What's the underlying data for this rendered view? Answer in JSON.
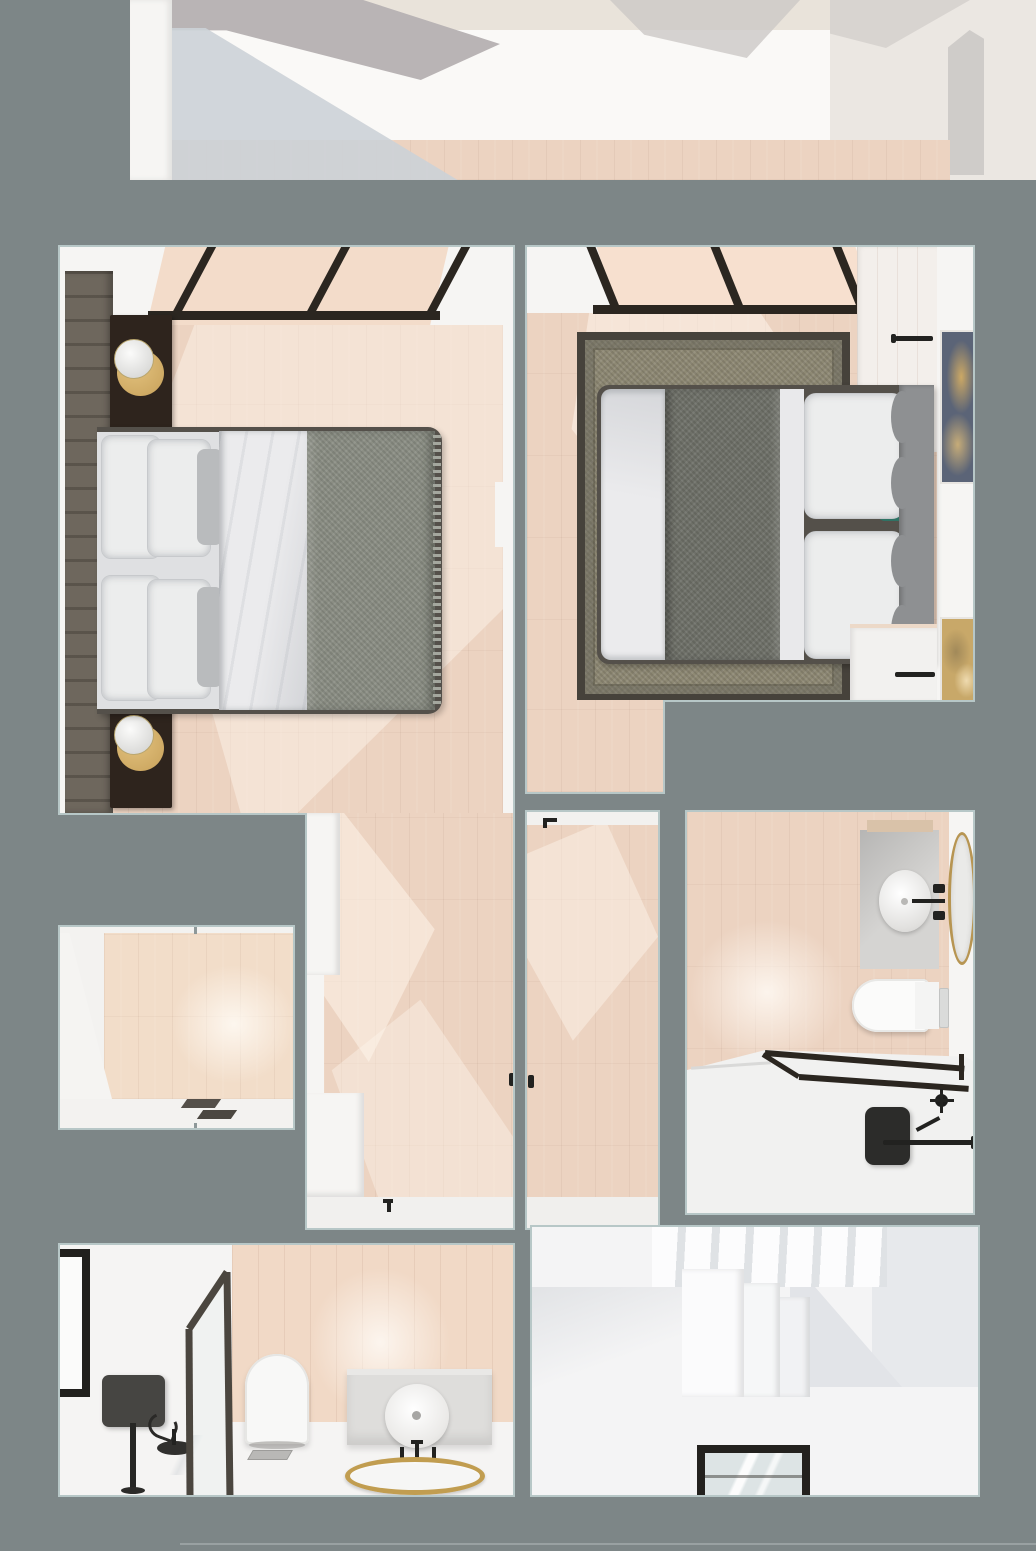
{
  "scene": {
    "kind": "apartment-interior-top-down-render",
    "description": "3D dollhouse-style top view of a small apartment: two bedrooms at top, walk-through corridor and hallway in the middle, bathroom on the right, walk-in closet room on the left, shower bathroom at bottom left, staircase room at bottom right",
    "background_color": "#7d8687"
  },
  "palette": {
    "bg": "#7d8687",
    "cut": "#b7c7c7",
    "wall": "#f6f5f3",
    "walldim": "#efede9",
    "floor": "#ecd3c1",
    "floorlight": "#f7e7d8",
    "frame": "#2b2620",
    "hbwall": "#6e675d",
    "night": "#2e241d",
    "brass": "#c7a15a",
    "duvet": "#ebebed",
    "pillow": "#eceded",
    "pillowline": "#c7c9cc",
    "throw": "#8b8e84",
    "bedframe": "#54504a",
    "rugborder": "#46423b",
    "rugfield": "#8e8974",
    "runner": "#6f7169",
    "teal": "#2f7365",
    "headboard2": "#8e9092",
    "navy": "#5b6477",
    "goldart": "#c8a869",
    "counter": "#d5d4d2",
    "mirrorgold": "#b79552",
    "white": "#f4f3f2",
    "tub": "#f1f1f0",
    "dark": "#222220",
    "stairshadow": "#e7e9ec",
    "glass": "#dde4e5"
  },
  "rooms": [
    {
      "id": "upper-room",
      "label": "room strip at top edge",
      "furniture": [
        "pink wood floor band",
        "white walls",
        "soft shadows"
      ]
    },
    {
      "id": "bedroom-left",
      "label": "bedroom 1",
      "furniture": [
        "slatted headboard wall",
        "two dark nightstands with sphere lamps on brass discs",
        "double bed with white duvet and grey throw",
        "black-framed glass partition"
      ]
    },
    {
      "id": "bedroom-right",
      "label": "bedroom 2",
      "furniture": [
        "olive bordered rug",
        "bed with textured grey runner, white pillows, teal cushions, grey scalloped headboard",
        "two framed artworks",
        "skylight with black frames",
        "built-in wardrobe",
        "black towel rails"
      ]
    },
    {
      "id": "corridor",
      "label": "walk-through corridor with white wardrobes"
    },
    {
      "id": "hallway",
      "label": "central hallway with doors"
    },
    {
      "id": "bathroom-right",
      "label": "bathroom with round basin vanity, gold oval mirror, toilet, glass-screened tub, black shower fittings"
    },
    {
      "id": "closet-room",
      "label": "small room with doormat"
    },
    {
      "id": "bathroom-bottom",
      "label": "shower bathroom with glass screen, toilet, vanity with round basin and gold ring mirror, black shower column"
    },
    {
      "id": "stair-room",
      "label": "staircase room with white steps and black-framed glass floor panel"
    }
  ]
}
